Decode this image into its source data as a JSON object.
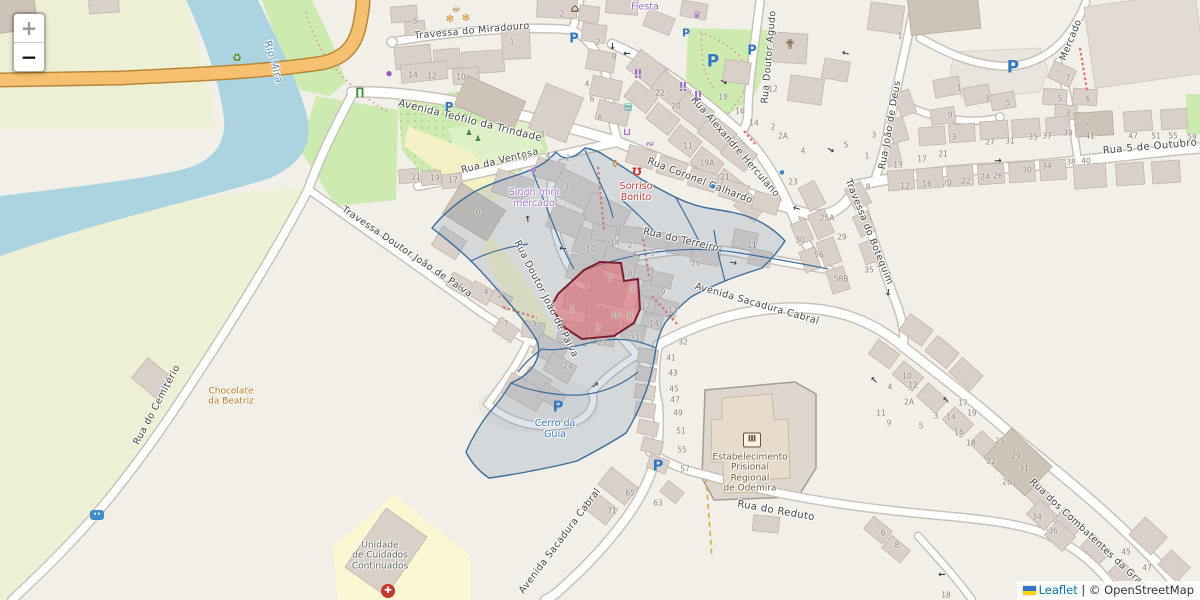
{
  "attribution": {
    "leaflet": "Leaflet",
    "separator": " | © ",
    "osm": "OpenStreetMap"
  },
  "zoom_control": {
    "zoom_in_label": "+",
    "zoom_out_label": "−"
  },
  "theme": {
    "overlay_blue_stroke": "#3c6d9c",
    "overlay_blue_fill": "rgba(128,152,176,0.26)",
    "overlay_red_stroke": "#7a1f33",
    "overlay_red_fill": "rgba(228,100,110,0.55)",
    "water": "#abd4e0",
    "road_orange": "#f5c06f",
    "parking_blue": "#3579bd"
  },
  "street_labels": [
    {
      "t": "Travessa do Miradouro",
      "x": 472,
      "y": 31,
      "r": -5,
      "s": 9.5
    },
    {
      "t": "Avenida Teófilo da Trindade",
      "x": 470,
      "y": 121,
      "r": 14,
      "s": 10
    },
    {
      "t": "Rua da Ventosa",
      "x": 500,
      "y": 161,
      "r": -14,
      "s": 9.5
    },
    {
      "t": "Rua Coronel Galhardo",
      "x": 700,
      "y": 181,
      "r": 21,
      "s": 9.5
    },
    {
      "t": "Rua Alexandre Herculano",
      "x": 735,
      "y": 147,
      "r": 49,
      "s": 9.5
    },
    {
      "t": "Rua Doutor Agudo",
      "x": 769,
      "y": 57,
      "r": -85,
      "s": 9.5
    },
    {
      "t": "Mercado",
      "x": 1071,
      "y": 40,
      "r": -68,
      "s": 9.5
    },
    {
      "t": "Rua João de Deus",
      "x": 890,
      "y": 125,
      "r": -80,
      "s": 9.5
    },
    {
      "t": "Rua 5 de Outubro",
      "x": 1150,
      "y": 147,
      "r": -5,
      "s": 10
    },
    {
      "t": "Travessa do Botequim",
      "x": 869,
      "y": 232,
      "r": 68,
      "s": 9.5
    },
    {
      "t": "Rua do Terreiro",
      "x": 681,
      "y": 240,
      "r": 13,
      "s": 9.5
    },
    {
      "t": "Avenida Sacadura Cabral",
      "x": 757,
      "y": 304,
      "r": 16,
      "s": 9.5
    },
    {
      "t": "Rua Doutor João de Paiva",
      "x": 546,
      "y": 299,
      "r": 63,
      "s": 9.5
    },
    {
      "t": "Travessa Doutor João de Paiva",
      "x": 407,
      "y": 252,
      "r": 34,
      "s": 9.5
    },
    {
      "t": "Rua do Cemitério",
      "x": 157,
      "y": 405,
      "r": -62,
      "s": 9.5
    },
    {
      "t": "Rua do Reduto",
      "x": 776,
      "y": 511,
      "r": 10,
      "s": 10
    },
    {
      "t": "Avenida Sacadura Cabral",
      "x": 560,
      "y": 541,
      "r": -53,
      "s": 9.5
    },
    {
      "t": "Rua dos Combatentes da Gran",
      "x": 1088,
      "y": 534,
      "r": 43,
      "s": 9.5
    },
    {
      "t": "Rio Mira",
      "x": 273,
      "y": 62,
      "r": 74,
      "s": 10,
      "c": "#5e8cbe"
    }
  ],
  "poi_labels": [
    {
      "t": "Fiesta",
      "x": 645,
      "y": 8,
      "c": "#a06cc8",
      "s": 9.5
    },
    {
      "t": "Singh mini\nmercado",
      "x": 534,
      "y": 199,
      "c": "#a87bc9",
      "s": 9.5
    },
    {
      "t": "Sorriso\nBonito",
      "x": 636,
      "y": 193,
      "c": "#cb3d3d",
      "s": 9.5
    },
    {
      "t": "Chocolate\nda Beatriz",
      "x": 231,
      "y": 397,
      "c": "#b8791f",
      "s": 9
    },
    {
      "t": "Cerro da\nGuia",
      "x": 555,
      "y": 430,
      "c": "#3d7bc0",
      "s": 9.5
    },
    {
      "t": "Unidade\nde Cuidados\nContinuados",
      "x": 380,
      "y": 556,
      "c": "#62685a",
      "s": 9
    },
    {
      "t": "Estabelecimento\nPrisional\nRegional\nde Odemira",
      "x": 750,
      "y": 473,
      "c": "#6f6046",
      "s": 9
    }
  ],
  "house_numbers": [
    {
      "t": "5",
      "x": 415,
      "y": 21
    },
    {
      "t": "14",
      "x": 413,
      "y": 75
    },
    {
      "t": "12",
      "x": 432,
      "y": 76
    },
    {
      "t": "10",
      "x": 461,
      "y": 77
    },
    {
      "t": "1",
      "x": 512,
      "y": 42
    },
    {
      "t": "2",
      "x": 562,
      "y": 14
    },
    {
      "t": "2",
      "x": 598,
      "y": 42
    },
    {
      "t": "8",
      "x": 614,
      "y": 57
    },
    {
      "t": "4",
      "x": 587,
      "y": 84
    },
    {
      "t": "6",
      "x": 592,
      "y": 99
    },
    {
      "t": "8",
      "x": 600,
      "y": 118
    },
    {
      "t": "21",
      "x": 416,
      "y": 177
    },
    {
      "t": "19",
      "x": 435,
      "y": 178
    },
    {
      "t": "17",
      "x": 453,
      "y": 180
    },
    {
      "t": "1",
      "x": 543,
      "y": 134
    },
    {
      "t": "6",
      "x": 525,
      "y": 158
    },
    {
      "t": "4",
      "x": 548,
      "y": 156
    },
    {
      "t": "2",
      "x": 568,
      "y": 158
    },
    {
      "t": "1",
      "x": 567,
      "y": 186
    },
    {
      "t": "6",
      "x": 478,
      "y": 212
    },
    {
      "t": "22",
      "x": 660,
      "y": 93
    },
    {
      "t": "20",
      "x": 676,
      "y": 106
    },
    {
      "t": "19",
      "x": 723,
      "y": 97
    },
    {
      "t": "16",
      "x": 740,
      "y": 111
    },
    {
      "t": "14",
      "x": 754,
      "y": 123
    },
    {
      "t": "2",
      "x": 773,
      "y": 127
    },
    {
      "t": "2A",
      "x": 783,
      "y": 136
    },
    {
      "t": "11",
      "x": 688,
      "y": 146
    },
    {
      "t": "19A",
      "x": 707,
      "y": 163
    },
    {
      "t": "21",
      "x": 725,
      "y": 177
    },
    {
      "t": "23",
      "x": 793,
      "y": 182
    },
    {
      "t": "12",
      "x": 773,
      "y": 89
    },
    {
      "t": "1",
      "x": 900,
      "y": 36
    },
    {
      "t": "4",
      "x": 803,
      "y": 151
    },
    {
      "t": "5",
      "x": 846,
      "y": 145
    },
    {
      "t": "1",
      "x": 867,
      "y": 156
    },
    {
      "t": "8",
      "x": 868,
      "y": 187
    },
    {
      "t": "3",
      "x": 874,
      "y": 135
    },
    {
      "t": "13",
      "x": 898,
      "y": 165
    },
    {
      "t": "25A",
      "x": 827,
      "y": 218
    },
    {
      "t": "29",
      "x": 842,
      "y": 237
    },
    {
      "t": "30",
      "x": 800,
      "y": 240
    },
    {
      "t": "56",
      "x": 819,
      "y": 255
    },
    {
      "t": "58B",
      "x": 841,
      "y": 279
    },
    {
      "t": "35",
      "x": 869,
      "y": 270
    },
    {
      "t": "1",
      "x": 959,
      "y": 88
    },
    {
      "t": "3",
      "x": 987,
      "y": 99
    },
    {
      "t": "5",
      "x": 1008,
      "y": 103
    },
    {
      "t": "9",
      "x": 950,
      "y": 115
    },
    {
      "t": "3",
      "x": 954,
      "y": 137
    },
    {
      "t": "21",
      "x": 943,
      "y": 154
    },
    {
      "t": "17",
      "x": 922,
      "y": 159
    },
    {
      "t": "12",
      "x": 905,
      "y": 186
    },
    {
      "t": "16",
      "x": 927,
      "y": 184
    },
    {
      "t": "20",
      "x": 947,
      "y": 183
    },
    {
      "t": "22",
      "x": 966,
      "y": 181
    },
    {
      "t": "24",
      "x": 985,
      "y": 177
    },
    {
      "t": "26",
      "x": 998,
      "y": 176
    },
    {
      "t": "30",
      "x": 1027,
      "y": 170
    },
    {
      "t": "34",
      "x": 1047,
      "y": 166
    },
    {
      "t": "38",
      "x": 1071,
      "y": 162
    },
    {
      "t": "40",
      "x": 1086,
      "y": 161
    },
    {
      "t": "27",
      "x": 990,
      "y": 142
    },
    {
      "t": "31",
      "x": 1010,
      "y": 141
    },
    {
      "t": "35",
      "x": 1033,
      "y": 137
    },
    {
      "t": "37",
      "x": 1047,
      "y": 136
    },
    {
      "t": "39",
      "x": 1068,
      "y": 133
    },
    {
      "t": "41",
      "x": 1090,
      "y": 136
    },
    {
      "t": "47",
      "x": 1133,
      "y": 136
    },
    {
      "t": "51",
      "x": 1156,
      "y": 136
    },
    {
      "t": "55",
      "x": 1173,
      "y": 136
    },
    {
      "t": "59",
      "x": 1192,
      "y": 137
    },
    {
      "t": "7",
      "x": 1068,
      "y": 78
    },
    {
      "t": "5",
      "x": 1060,
      "y": 99
    },
    {
      "t": "6",
      "x": 1088,
      "y": 99
    },
    {
      "t": "3",
      "x": 1068,
      "y": 113
    },
    {
      "t": "2",
      "x": 1088,
      "y": 122
    },
    {
      "t": "10",
      "x": 591,
      "y": 249
    },
    {
      "t": "14",
      "x": 615,
      "y": 243
    },
    {
      "t": "2",
      "x": 630,
      "y": 245
    },
    {
      "t": "4",
      "x": 635,
      "y": 254
    },
    {
      "t": "3",
      "x": 652,
      "y": 253
    },
    {
      "t": "26",
      "x": 696,
      "y": 263
    },
    {
      "t": "11",
      "x": 752,
      "y": 245
    },
    {
      "t": "7",
      "x": 652,
      "y": 273
    },
    {
      "t": "8",
      "x": 630,
      "y": 273
    },
    {
      "t": "9",
      "x": 663,
      "y": 292
    },
    {
      "t": "12",
      "x": 646,
      "y": 306
    },
    {
      "t": "13",
      "x": 673,
      "y": 310
    },
    {
      "t": "14",
      "x": 654,
      "y": 324
    },
    {
      "t": "31",
      "x": 635,
      "y": 338
    },
    {
      "t": "27",
      "x": 602,
      "y": 343
    },
    {
      "t": "24",
      "x": 568,
      "y": 366
    },
    {
      "t": "32",
      "x": 683,
      "y": 342
    },
    {
      "t": "7",
      "x": 610,
      "y": 279
    },
    {
      "t": "9",
      "x": 632,
      "y": 289
    },
    {
      "t": "1",
      "x": 572,
      "y": 309
    },
    {
      "t": "2",
      "x": 598,
      "y": 328
    },
    {
      "t": "16",
      "x": 616,
      "y": 315
    },
    {
      "t": "8",
      "x": 630,
      "y": 316
    },
    {
      "t": "6",
      "x": 460,
      "y": 288
    },
    {
      "t": "4",
      "x": 486,
      "y": 292
    },
    {
      "t": "2",
      "x": 500,
      "y": 295
    },
    {
      "t": "7",
      "x": 506,
      "y": 324
    },
    {
      "t": "3",
      "x": 534,
      "y": 324
    },
    {
      "t": "41",
      "x": 671,
      "y": 358
    },
    {
      "t": "43",
      "x": 673,
      "y": 373
    },
    {
      "t": "45",
      "x": 674,
      "y": 389
    },
    {
      "t": "47",
      "x": 675,
      "y": 400
    },
    {
      "t": "49",
      "x": 678,
      "y": 413
    },
    {
      "t": "51",
      "x": 681,
      "y": 431
    },
    {
      "t": "55",
      "x": 682,
      "y": 450
    },
    {
      "t": "57",
      "x": 685,
      "y": 469
    },
    {
      "t": "65",
      "x": 630,
      "y": 493
    },
    {
      "t": "71",
      "x": 612,
      "y": 511
    },
    {
      "t": "63",
      "x": 658,
      "y": 503
    },
    {
      "t": "10",
      "x": 907,
      "y": 376
    },
    {
      "t": "12",
      "x": 913,
      "y": 385
    },
    {
      "t": "2A",
      "x": 909,
      "y": 402
    },
    {
      "t": "11",
      "x": 881,
      "y": 413
    },
    {
      "t": "9",
      "x": 889,
      "y": 423
    },
    {
      "t": "4",
      "x": 890,
      "y": 387
    },
    {
      "t": "3",
      "x": 936,
      "y": 416
    },
    {
      "t": "14",
      "x": 951,
      "y": 417
    },
    {
      "t": "5",
      "x": 921,
      "y": 426
    },
    {
      "t": "6",
      "x": 883,
      "y": 533
    },
    {
      "t": "8",
      "x": 897,
      "y": 545
    },
    {
      "t": "17",
      "x": 963,
      "y": 403
    },
    {
      "t": "19",
      "x": 972,
      "y": 413
    },
    {
      "t": "16",
      "x": 959,
      "y": 432
    },
    {
      "t": "18",
      "x": 971,
      "y": 443
    },
    {
      "t": "25",
      "x": 1000,
      "y": 441
    },
    {
      "t": "22",
      "x": 991,
      "y": 461
    },
    {
      "t": "29",
      "x": 1016,
      "y": 456
    },
    {
      "t": "31",
      "x": 1024,
      "y": 468
    },
    {
      "t": "26",
      "x": 1007,
      "y": 482
    },
    {
      "t": "34",
      "x": 1037,
      "y": 517
    },
    {
      "t": "36",
      "x": 1053,
      "y": 531
    },
    {
      "t": "45",
      "x": 1126,
      "y": 552
    },
    {
      "t": "47",
      "x": 1147,
      "y": 568
    },
    {
      "t": "18",
      "x": 946,
      "y": 595
    }
  ],
  "icons": [
    {
      "n": "recycling-icon",
      "t": "♻",
      "x": 237,
      "y": 58,
      "c": "#567d20",
      "s": 11
    },
    {
      "n": "picnic-table-icon",
      "t": "∏",
      "x": 360,
      "y": 92,
      "c": "#3d8b37",
      "s": 11
    },
    {
      "n": "shop-dot-icon",
      "t": "●",
      "x": 389,
      "y": 74,
      "c": "#9b59b6",
      "s": 7
    },
    {
      "n": "flower-icon",
      "t": "✻",
      "x": 450,
      "y": 20,
      "c": "#d08a2e",
      "s": 10
    },
    {
      "n": "flower-icon",
      "t": "✻",
      "x": 466,
      "y": 19,
      "c": "#d08a2e",
      "s": 10
    },
    {
      "n": "cafe-cup-icon",
      "t": "☕",
      "x": 456,
      "y": 8,
      "c": "#9c5a1e",
      "s": 11
    },
    {
      "n": "house-icon",
      "t": "⌂",
      "x": 575,
      "y": 8,
      "c": "#7d5a36",
      "s": 12
    },
    {
      "n": "crown-icon",
      "t": "♛",
      "x": 697,
      "y": 16,
      "c": "#a06cc8",
      "s": 10
    },
    {
      "n": "clothes-shop-icon",
      "t": "‼",
      "x": 638,
      "y": 74,
      "c": "#a06cc8",
      "s": 12
    },
    {
      "n": "clothes-shop-icon",
      "t": "‼",
      "x": 683,
      "y": 87,
      "c": "#a06cc8",
      "s": 12
    },
    {
      "n": "clothes-shop-icon",
      "t": "‼",
      "x": 698,
      "y": 96,
      "c": "#a06cc8",
      "s": 12
    },
    {
      "n": "kiosk-icon",
      "t": "▤",
      "x": 628,
      "y": 108,
      "c": "#2a9d8f",
      "s": 9
    },
    {
      "n": "shopping-cart-icon",
      "t": "⊔",
      "x": 627,
      "y": 133,
      "c": "#a06cc8",
      "s": 10
    },
    {
      "n": "shoe-shop-icon",
      "t": "∾",
      "x": 650,
      "y": 145,
      "c": "#a06cc8",
      "s": 10
    },
    {
      "n": "bar-glass-icon",
      "t": "⚱",
      "x": 615,
      "y": 164,
      "c": "#c07a28",
      "s": 11
    },
    {
      "n": "dentist-tooth-icon",
      "t": "Ω",
      "x": 637,
      "y": 171,
      "c": "#c8342c",
      "s": 11,
      "r": 180
    },
    {
      "n": "church-icon",
      "t": "✟",
      "x": 790,
      "y": 45,
      "c": "#6b4f2e",
      "s": 13
    },
    {
      "n": "convenience-store-icon",
      "t": "❖",
      "x": 533,
      "y": 172,
      "c": "#a06cc8",
      "s": 9
    },
    {
      "n": "parking-icon",
      "t": "P",
      "x": 574,
      "y": 39,
      "c": "#3579bd",
      "s": 13
    },
    {
      "n": "parking-icon",
      "t": "P",
      "x": 686,
      "y": 33,
      "c": "#3579bd",
      "s": 11
    },
    {
      "n": "parking-icon",
      "t": "P",
      "x": 713,
      "y": 62,
      "c": "#3579bd",
      "s": 17
    },
    {
      "n": "parking-icon",
      "t": "P",
      "x": 752,
      "y": 51,
      "c": "#3579bd",
      "s": 13
    },
    {
      "n": "parking-icon",
      "t": "P",
      "x": 449,
      "y": 107,
      "c": "#3579bd",
      "s": 12
    },
    {
      "n": "parking-icon",
      "t": "P",
      "x": 1013,
      "y": 68,
      "c": "#3579bd",
      "s": 17
    },
    {
      "n": "parking-icon",
      "t": "P",
      "x": 558,
      "y": 407,
      "c": "#3579bd",
      "s": 15
    },
    {
      "n": "parking-icon",
      "t": "P",
      "x": 658,
      "y": 466,
      "c": "#3579bd",
      "s": 15
    },
    {
      "n": "playground-icon",
      "t": "♟",
      "x": 469,
      "y": 133,
      "c": "#3d8b37",
      "s": 8
    },
    {
      "n": "playground-icon",
      "t": "♟",
      "x": 478,
      "y": 139,
      "c": "#3d8b37",
      "s": 8
    },
    {
      "n": "fountain-icon",
      "t": "●",
      "x": 713,
      "y": 187,
      "c": "#3d85c8",
      "s": 6
    },
    {
      "n": "fountain-icon",
      "t": "●",
      "x": 782,
      "y": 173,
      "c": "#3d85c8",
      "s": 6
    },
    {
      "n": "bus-stop-icon",
      "t": "••",
      "x": 97,
      "y": 515,
      "k": "bus"
    },
    {
      "n": "prison-icon",
      "t": "Ⅲ",
      "x": 752,
      "y": 440,
      "k": "prison"
    },
    {
      "n": "hospital-cross-icon",
      "t": "✚",
      "x": 388,
      "y": 591,
      "k": "hosp"
    },
    {
      "n": "oneway-arrow-icon",
      "t": "→",
      "x": 611,
      "y": 46,
      "c": "#3c3c3c",
      "s": 9,
      "r": 90
    },
    {
      "n": "oneway-arrow-icon",
      "t": "→",
      "x": 627,
      "y": 52,
      "c": "#3c3c3c",
      "s": 9,
      "r": 180
    },
    {
      "n": "oneway-arrow-icon",
      "t": "→",
      "x": 723,
      "y": 83,
      "c": "#3c3c3c",
      "s": 9,
      "r": 28
    },
    {
      "n": "oneway-arrow-icon",
      "t": "→",
      "x": 846,
      "y": 52,
      "c": "#3c3c3c",
      "s": 9,
      "r": 195
    },
    {
      "n": "oneway-arrow-icon",
      "t": "→",
      "x": 529,
      "y": 219,
      "c": "#3c3c3c",
      "s": 9,
      "r": -95
    },
    {
      "n": "oneway-arrow-icon",
      "t": "→",
      "x": 563,
      "y": 247,
      "c": "#3c3c3c",
      "s": 9,
      "r": 185
    },
    {
      "n": "oneway-arrow-icon",
      "t": "→",
      "x": 733,
      "y": 264,
      "c": "#3c3c3c",
      "s": 9,
      "r": 12
    },
    {
      "n": "oneway-arrow-icon",
      "t": "→",
      "x": 887,
      "y": 292,
      "c": "#3c3c3c",
      "s": 9,
      "r": 98
    },
    {
      "n": "oneway-arrow-icon",
      "t": "→",
      "x": 797,
      "y": 207,
      "c": "#3c3c3c",
      "s": 9,
      "r": 196
    },
    {
      "n": "oneway-arrow-icon",
      "t": "→",
      "x": 875,
      "y": 379,
      "c": "#3c3c3c",
      "s": 9,
      "r": 225
    },
    {
      "n": "oneway-arrow-icon",
      "t": "→",
      "x": 947,
      "y": 399,
      "c": "#3c3c3c",
      "s": 9,
      "r": 225
    },
    {
      "n": "oneway-arrow-icon",
      "t": "→",
      "x": 942,
      "y": 573,
      "c": "#3c3c3c",
      "s": 9,
      "r": 180
    },
    {
      "n": "oneway-arrow-icon",
      "t": "→",
      "x": 596,
      "y": 386,
      "c": "#3c3c3c",
      "s": 9,
      "r": -40
    },
    {
      "n": "oneway-arrow-icon",
      "t": "→",
      "x": 998,
      "y": 162,
      "c": "#3c3c3c",
      "s": 9,
      "r": -4
    },
    {
      "n": "oneway-arrow-icon",
      "t": "→",
      "x": 830,
      "y": 151,
      "c": "#3c3c3c",
      "s": 9,
      "r": 30
    }
  ]
}
